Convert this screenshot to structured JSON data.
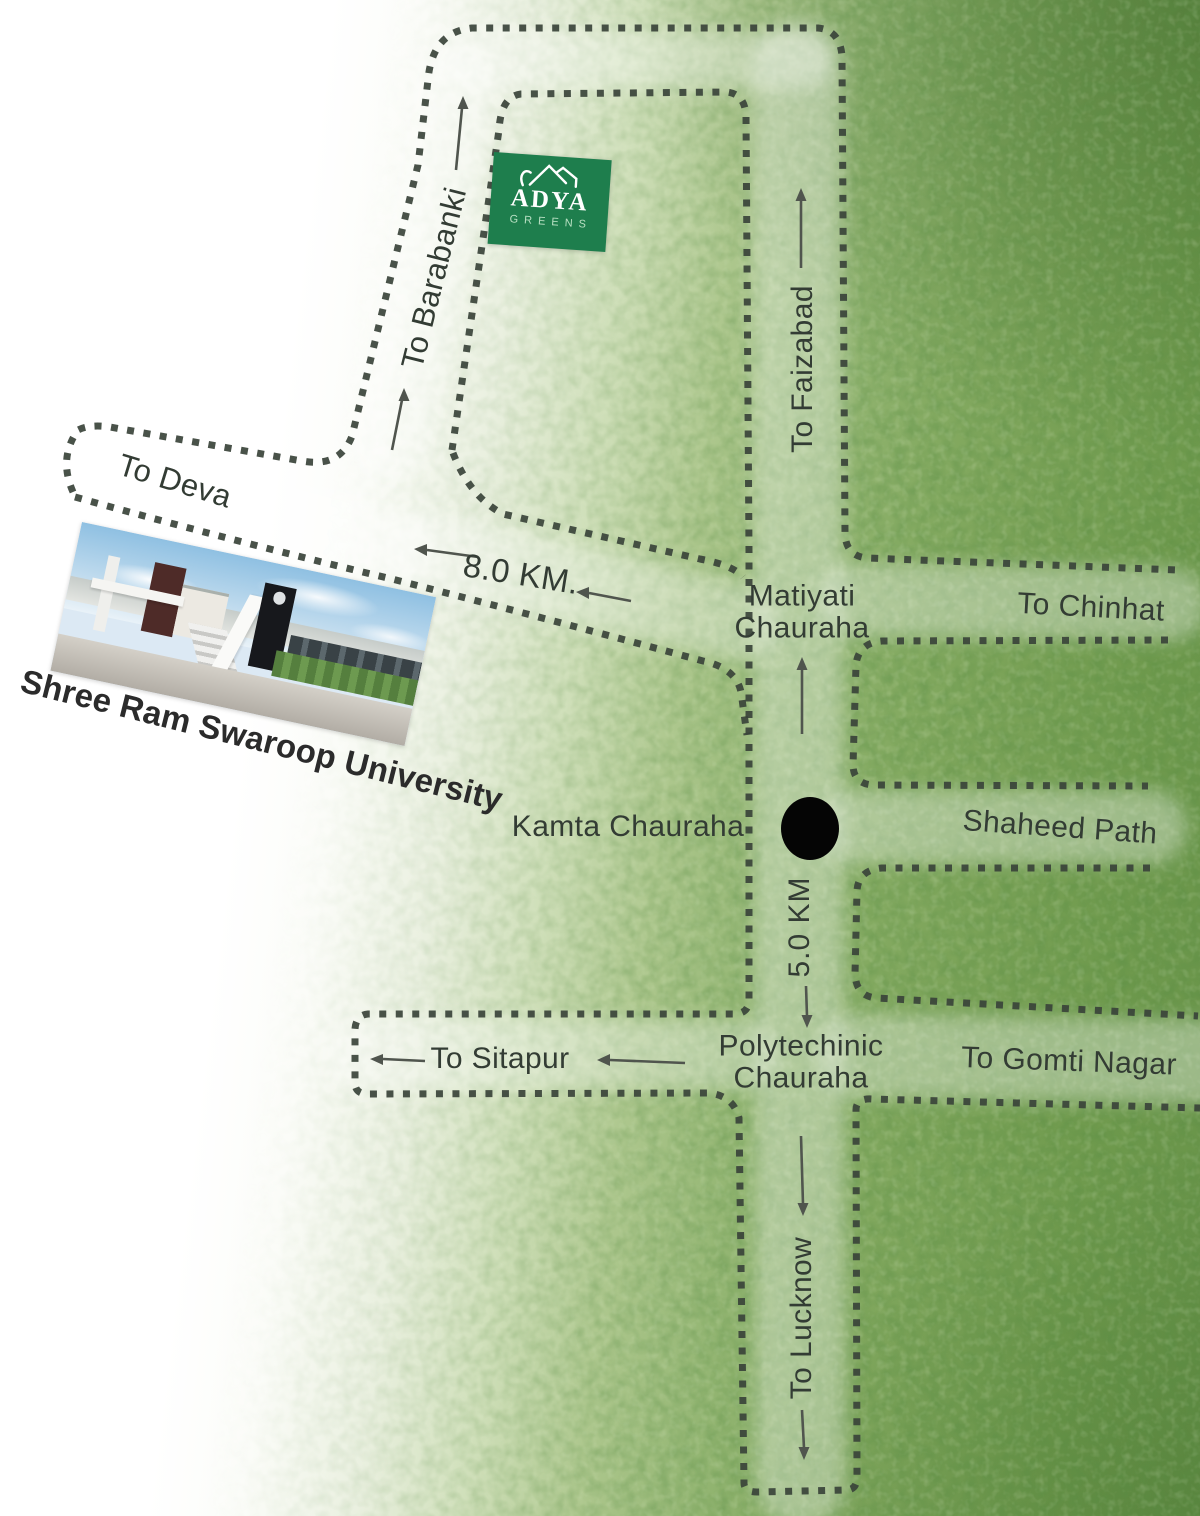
{
  "site_logo": {
    "brand": "ADYA",
    "tagline": "GREENS"
  },
  "landmark": {
    "caption": "Shree Ram Swaroop University"
  },
  "destinations": {
    "barabanki": "To Barabanki",
    "deva": "To Deva",
    "faizabad": "To Faizabad",
    "chinhat": "To Chinhat",
    "sitapur": "To Sitapur",
    "gomti_nagar": "To Gomti Nagar",
    "lucknow": "To Lucknow"
  },
  "junctions": {
    "matiyati": {
      "line1": "Matiyati",
      "line2": "Chauraha"
    },
    "kamta": {
      "name": "Kamta Chauraha"
    },
    "polytechinic": {
      "line1": "Polytechinic",
      "line2": "Chauraha"
    },
    "shaheed_path": "Shaheed Path"
  },
  "distances": {
    "university_leg": "8.0 KM.",
    "kamta_to_polytechinic_leg": "5.0 KM"
  },
  "colors": {
    "road_dot": "#3a433a",
    "label_text": "#333c34",
    "junction_marker": "#050505",
    "logo_green": "#1e7e4d",
    "map_green": "#7aa45a"
  }
}
